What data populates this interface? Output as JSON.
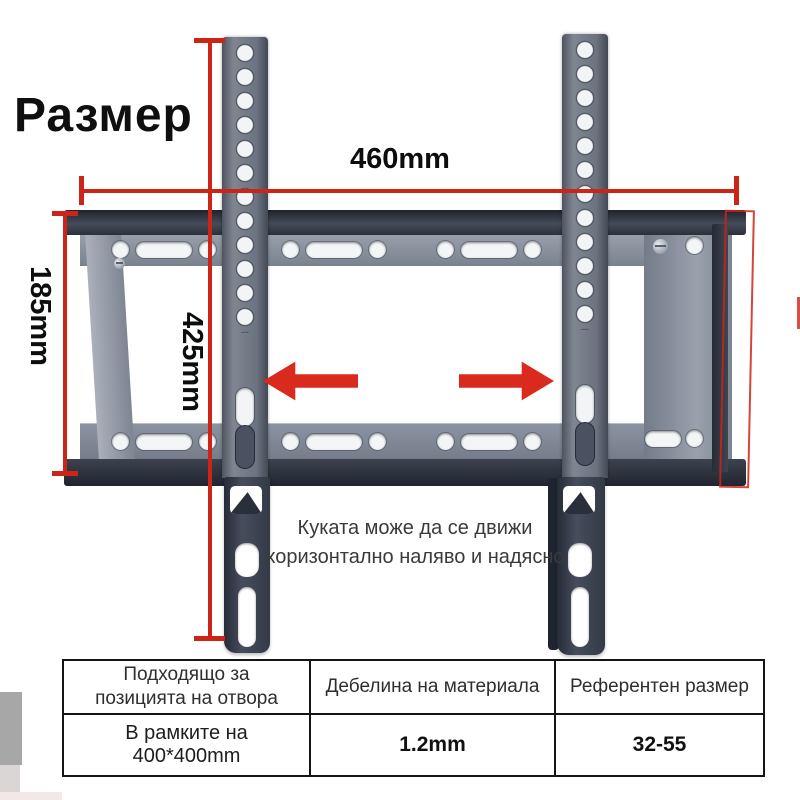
{
  "title": "Размер",
  "annotations": {
    "width": "460mm",
    "height": "425mm",
    "side": "185mm",
    "note_line1": "Куката може да се движи",
    "note_line2": "хоризонтално наляво и надясно"
  },
  "table": {
    "columns": [
      {
        "header": "Подходящо за позицията на отвора",
        "value": "В рамките на 400*400mm"
      },
      {
        "header": "Дебелина на материала",
        "value": "1.2mm"
      },
      {
        "header": "Референтен размер",
        "value": "32-55"
      }
    ]
  },
  "colors": {
    "annotation_red": "#cd2418",
    "arrow_red": "#da291d",
    "metal_light": "#8b93a0",
    "metal_dark": "#2b303b",
    "hook_dark": "#333945",
    "table_border": "#151515"
  },
  "icons": {
    "left_arrow": "left-arrow-icon",
    "right_arrow": "right-arrow-icon"
  }
}
